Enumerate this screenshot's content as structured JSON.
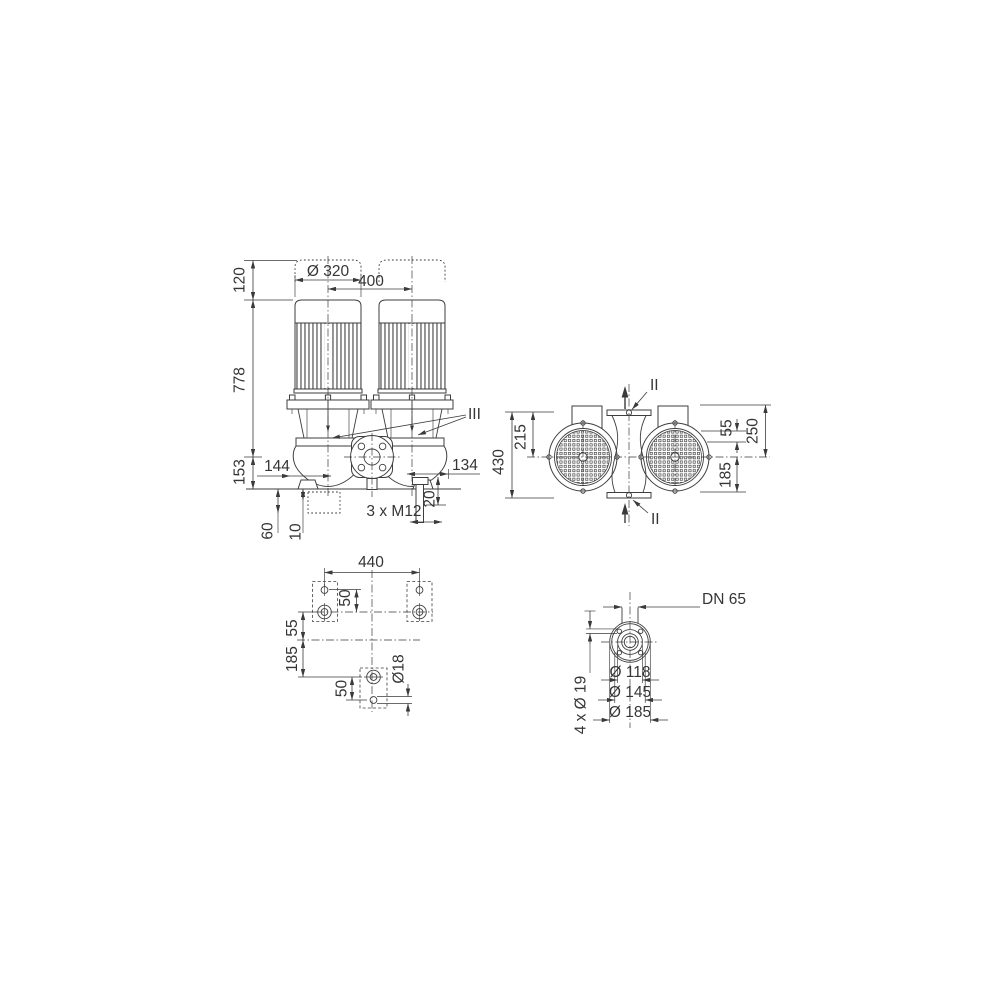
{
  "page": {
    "background": "#ffffff",
    "line_color": "#3e3e3e",
    "text_color": "#353535"
  },
  "views": {
    "front": {
      "dims": {
        "cap_height": "120",
        "motor_diameter": "Ø 320",
        "motor_spacing": "400",
        "pump_height": "778",
        "axis_height": "153",
        "inlet_offset": "144",
        "outlet_offset": "134",
        "foot_offset": "20",
        "foot_thread_note": "3 x M12",
        "foundation_depth": "60",
        "grout_thickness": "10",
        "section_marker": "III"
      }
    },
    "top": {
      "dims": {
        "overall_width": "430",
        "half_width": "215",
        "port_offset": "55",
        "flange_to_axis": "250",
        "axis_to_edge": "185",
        "section_marker_top": "II",
        "section_marker_bottom": "II"
      }
    },
    "base": {
      "dims": {
        "bolt_span": "440",
        "hole_pitch_top": "50",
        "axis_offset": "55",
        "axis_to_front": "185",
        "hole_pitch_bottom": "50",
        "hole_diameter": "Ø18"
      }
    },
    "flange": {
      "dims": {
        "nominal_diameter": "DN 65",
        "bolt_holes_note": "4 x Ø 19",
        "pilot_diameter": "Ø 118",
        "bolt_circle_diameter": "Ø 145",
        "outer_diameter": "Ø 185"
      }
    }
  }
}
